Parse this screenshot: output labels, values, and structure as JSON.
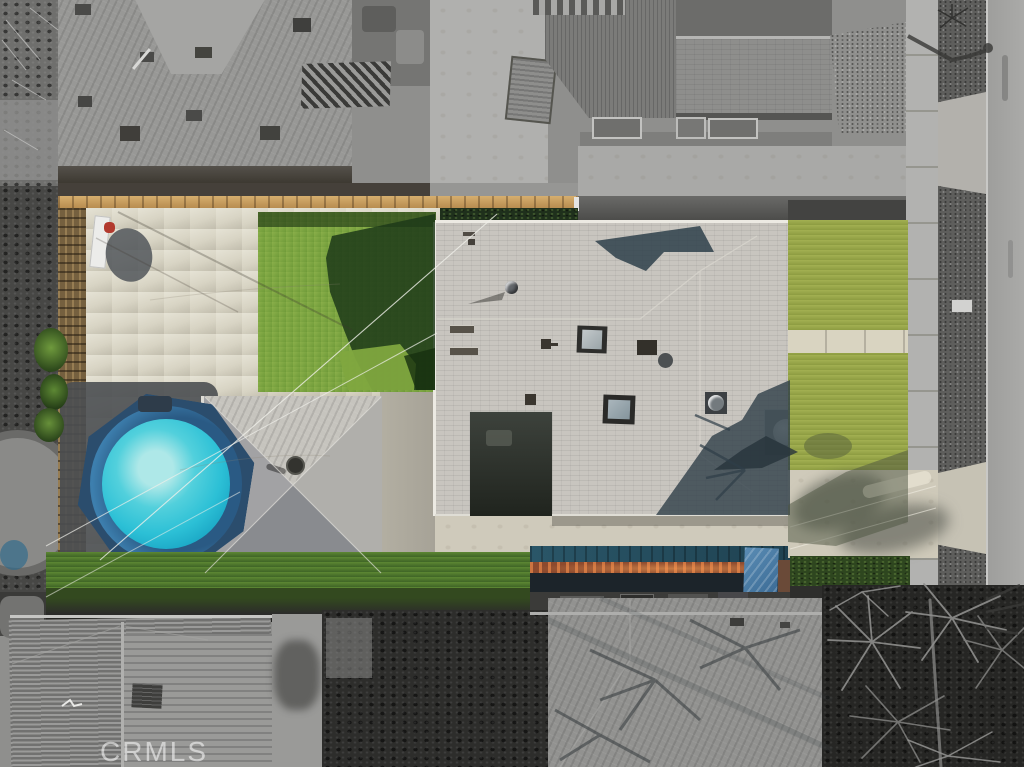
{
  "meta": {
    "type": "aerial-drone-photo",
    "description": "Top-down drone photo of a residential lot shown in full color (green lawns, above-ground turquoise pool, gray shingled house, pyramid-roof garage, teal patio cover) while all surrounding properties, sidewalk and street are desaturated to grayscale."
  },
  "watermark": {
    "text": "CRMLS"
  },
  "palette": {
    "pool_water": "#2cc0d6",
    "pool_water_light": "#aee8e8",
    "pool_rim_blue": "#3d7fae",
    "pool_deck_navy": "#2b4d6d",
    "back_lawn": "#7ba23d",
    "lawn_shadow": "#1d3a19",
    "front_lawn": "#9aa74a",
    "patio_concrete": "#d8d4c4",
    "house_roof": "#c8c5bf",
    "shed_roof": "#b5b3af",
    "fence_wood_tan": "#d6ae6e",
    "patio_cover_teal": "#2a5668",
    "patio_cover_wood": "#8d4a2e",
    "hedge_green": "#2e461f",
    "street_gray": "#a5a5a3",
    "sidewalk_gray": "#b2b2b0",
    "neighbor_roof_gray": "#989896",
    "dark_trees": "#2d2d2b"
  }
}
